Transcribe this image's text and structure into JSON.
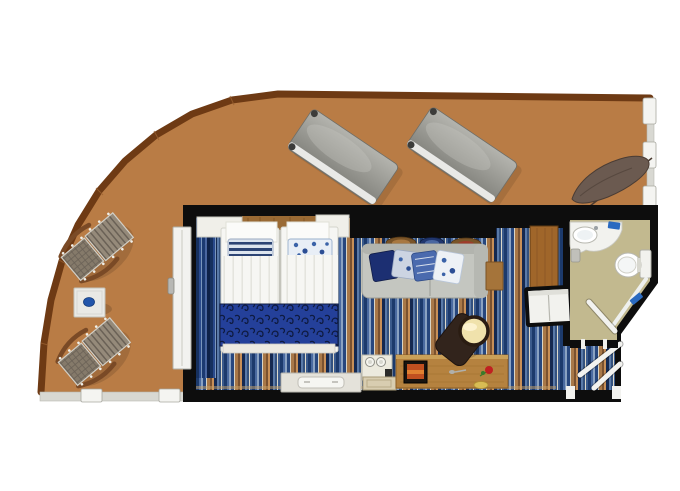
{
  "meta": {
    "title": "Cruise stateroom floor plan with wrap-around balcony"
  },
  "colors": {
    "deck": "#b97c45",
    "deck_border": "#6e3a14",
    "deck_border_joint": "#9a6030",
    "railing_band": "#d8d8d2",
    "railing_post": "#f4f4f1",
    "wall": "#0d0d0d",
    "bathroom_floor": "#c2b98f",
    "fixture": "#f2f2ee",
    "toilet": "#ffffff",
    "towel_blue": "#2a6ac0",
    "headboard_wood": "#9a6a34",
    "closet_wood": "#a0662a",
    "desk_wood": "#b5823f",
    "desk_edge": "#caa058",
    "bed_white": "#f6f6f3",
    "runner": "#24409a",
    "swirl": "#0e1a40",
    "sofa": "#c4c6c0",
    "sofa_back": "#b2b4ae",
    "sofa_pillows": [
      "#1c2f72",
      "#ccd4e2",
      "#4a6aae",
      "#edf1f6"
    ],
    "wardrobe": "#f2f2ee",
    "chair_dark": "#32241c",
    "chair_cushion": "#f0e2ac",
    "lounger_light": "#b4b4ae",
    "lounger_dark": "#80807a",
    "chair_weave": "#857a6a",
    "chair_slat": "#958a7a",
    "chair_arm": "#7a4a26",
    "table_white": "#e9e9e5",
    "table_dot": "#2255aa",
    "shade": "#6b5a50",
    "divider": "#4a3a30",
    "door_white": "#f2f2ef",
    "tv_screen": "#c05020",
    "rose_red": "#c02020",
    "rose_green": "#3a7a2a",
    "tray_yellow": "#d8bc54",
    "plate_brown": "#7a5428",
    "plate_blue": "#20366e",
    "bench_white": "#e4e2da",
    "minibar_white": "#eceade",
    "drawer_tan": "#d8cdb0"
  },
  "carpet": {
    "stripes": [
      {
        "c": "#1c3a6c",
        "w": 3
      },
      {
        "c": "#4a6aa0",
        "w": 2
      },
      {
        "c": "#8aa2c2",
        "w": 2
      },
      {
        "c": "#27477e",
        "w": 3
      },
      {
        "c": "#d8d4c6",
        "w": 1
      },
      {
        "c": "#a87848",
        "w": 3
      },
      {
        "c": "#7a5230",
        "w": 2
      },
      {
        "c": "#c89058",
        "w": 2
      },
      {
        "c": "#152950",
        "w": 3
      },
      {
        "c": "#5a7aa8",
        "w": 2
      },
      {
        "c": "#33517e",
        "w": 2
      },
      {
        "c": "#dcd8ca",
        "w": 1
      },
      {
        "c": "#3a5a8c",
        "w": 2
      }
    ]
  },
  "curtain": {
    "stripes": [
      {
        "c": "#16305e",
        "w": 3
      },
      {
        "c": "#2a4a8c",
        "w": 2
      },
      {
        "c": "#7a96bc",
        "w": 1
      },
      {
        "c": "#1c3a72",
        "w": 3
      },
      {
        "c": "#4a66a0",
        "w": 2
      },
      {
        "c": "#0e2148",
        "w": 3
      }
    ]
  },
  "balcony": {
    "items": [
      "deck-chair",
      "deck-chair",
      "side-table",
      "sun-lounger",
      "sun-lounger",
      "privacy-shade",
      "railing"
    ]
  },
  "cabin": {
    "items": [
      "twin-beds",
      "nightstand",
      "nightstand",
      "pillows",
      "foot-runner",
      "sofa",
      "sofa-cushions",
      "wall-shelf-trays",
      "coffee-table",
      "wardrobe",
      "closet",
      "desk",
      "vanity-stool",
      "tv",
      "minibar",
      "luggage-bench",
      "balcony-sliding-door",
      "curtain",
      "entry-door"
    ]
  },
  "bathroom": {
    "items": [
      "sink-vanity",
      "toilet",
      "shower",
      "bathroom-door",
      "towels",
      "waste-bin"
    ]
  }
}
